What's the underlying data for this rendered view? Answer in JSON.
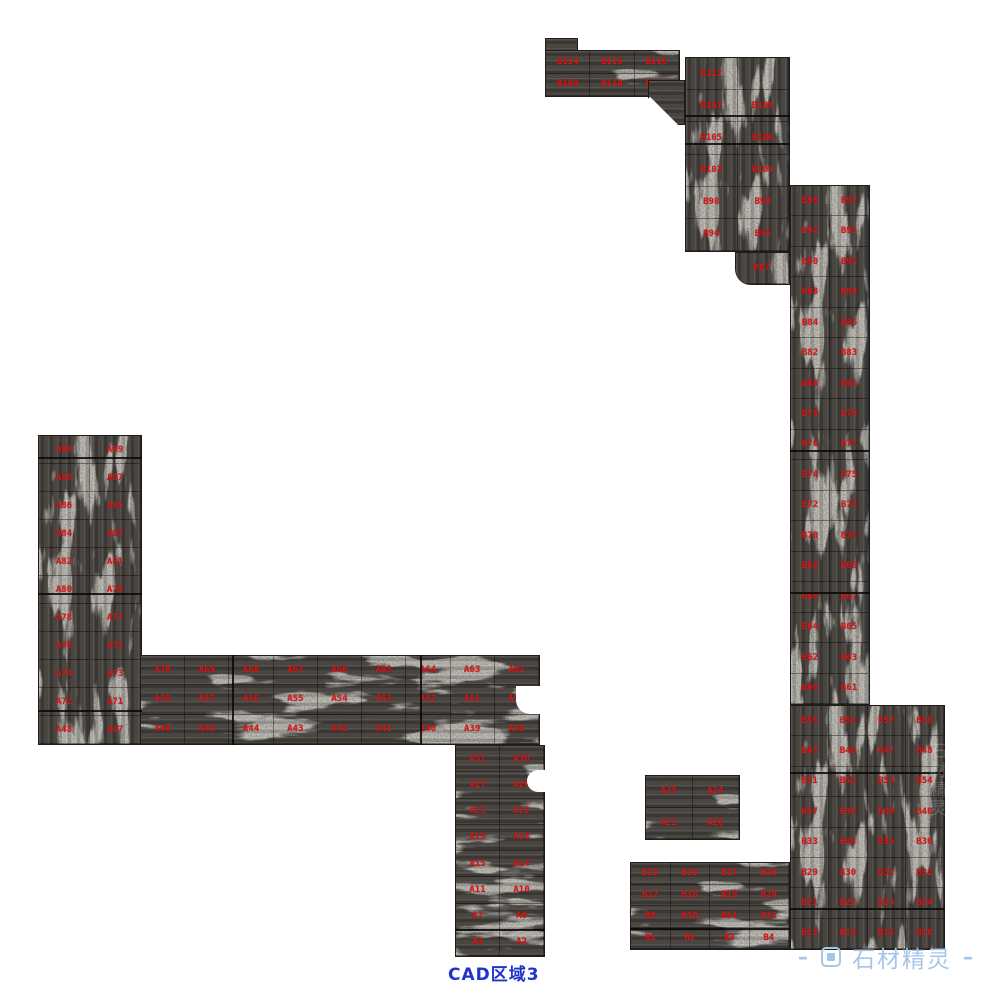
{
  "canvas": {
    "w": 982,
    "h": 1000
  },
  "caption": {
    "text": "CAD区域3"
  },
  "watermark": {
    "left_dash": "–",
    "right_dash": "–",
    "brand": "石材精灵"
  },
  "colors": {
    "label_red": "#e01212",
    "caption_blue": "#2233cc",
    "watermark_blue": "#a5c6e9",
    "stone_base": "#46423e",
    "stone_vein": "#d6d2c8"
  },
  "stamps": [
    {
      "x": 924,
      "y": 742,
      "text": "石材精灵",
      "opacity": 0.22
    },
    {
      "x": 940,
      "y": 88,
      "text": "石材精灵",
      "opacity": 0.13
    }
  ],
  "clusters": [
    {
      "id": "top-step",
      "x": 545,
      "y": 38,
      "w": 33,
      "h": 14,
      "dir": "h",
      "cols": 0,
      "rows": 0,
      "labels": []
    },
    {
      "id": "top-strip",
      "x": 545,
      "y": 50,
      "w": 135,
      "h": 47,
      "dir": "h",
      "cols": 3,
      "rows": 2,
      "labels": [
        [
          "B114",
          "B115",
          "B116"
        ],
        [
          "B109",
          "B110",
          "B111"
        ]
      ]
    },
    {
      "id": "strip-join",
      "x": 648,
      "y": 80,
      "w": 37,
      "h": 45,
      "dir": "h",
      "cols": 0,
      "rows": 0,
      "labels": []
    },
    {
      "id": "upper-right-column",
      "x": 685,
      "y": 57,
      "w": 105,
      "h": 195,
      "dir": "v",
      "cols": 2,
      "rows": 6,
      "labels": [
        [
          "B112",
          ""
        ],
        [
          "B107",
          "B108"
        ],
        [
          "B105",
          "B106"
        ],
        [
          "B103",
          "B104"
        ],
        [
          "B98",
          "B99"
        ],
        [
          "B94",
          "B95"
        ]
      ]
    },
    {
      "id": "column-foot",
      "x": 735,
      "y": 252,
      "w": 55,
      "h": 33,
      "dir": "v",
      "cols": 1,
      "rows": 1,
      "radius": "0 0 0 16px",
      "labels": [
        [
          "B87"
        ]
      ]
    },
    {
      "id": "right-main-column",
      "x": 790,
      "y": 185,
      "w": 80,
      "h": 520,
      "dir": "v",
      "cols": 2,
      "rows": 17,
      "labels": [
        [
          "B96",
          "B97"
        ],
        [
          "B92",
          "B93"
        ],
        [
          "B90",
          "B91"
        ],
        [
          "B88",
          "B89"
        ],
        [
          "B84",
          "B85"
        ],
        [
          "B82",
          "B83"
        ],
        [
          "B80",
          "B81"
        ],
        [
          "B78",
          "B79"
        ],
        [
          "B76",
          "B77"
        ],
        [
          "B74",
          "B75"
        ],
        [
          "B72",
          "B73"
        ],
        [
          "B70",
          "B71"
        ],
        [
          "B68",
          "B69"
        ],
        [
          "B66",
          "B67"
        ],
        [
          "B64",
          "B65"
        ],
        [
          "B62",
          "B63"
        ],
        [
          "B60",
          "B61"
        ]
      ]
    },
    {
      "id": "right-bottom-block",
      "x": 790,
      "y": 705,
      "w": 155,
      "h": 245,
      "dir": "v",
      "cols": 4,
      "rows": 8,
      "labels": [
        [
          "B55",
          "B56",
          "B57",
          "B58"
        ],
        [
          "B45",
          "B46",
          "B47",
          "B48"
        ],
        [
          "B51",
          "B52",
          "B53",
          "B54"
        ],
        [
          "B37",
          "B38",
          "B39",
          "B40"
        ],
        [
          "B33",
          "B34",
          "B35",
          "B36"
        ],
        [
          "B29",
          "B30",
          "B31",
          "B32"
        ],
        [
          "B21",
          "B22",
          "B23",
          "B24"
        ],
        [
          "B13",
          "B14",
          "B15",
          "B16"
        ]
      ]
    },
    {
      "id": "left-column",
      "x": 38,
      "y": 435,
      "w": 104,
      "h": 310,
      "dir": "v",
      "cols": 2,
      "rows": 11,
      "labels": [
        [
          "A90",
          "A89"
        ],
        [
          "A88",
          "A87"
        ],
        [
          "A86",
          "A85"
        ],
        [
          "A84",
          "A83"
        ],
        [
          "A82",
          "A81"
        ],
        [
          "A80",
          "A79"
        ],
        [
          "A78",
          "A77"
        ],
        [
          "A76",
          "A75"
        ],
        [
          "A74",
          "A73"
        ],
        [
          "A72",
          "A71"
        ],
        [
          "A48",
          "A47"
        ]
      ]
    },
    {
      "id": "middle-strip",
      "x": 140,
      "y": 655,
      "w": 400,
      "h": 90,
      "dir": "h",
      "cols": 9,
      "rows": 3,
      "labels": [
        [
          "A70",
          "A69",
          "A68",
          "A67",
          "A66",
          "A65",
          "A64",
          "A63",
          "A62"
        ],
        [
          "A58",
          "A57",
          "A56",
          "A55",
          "A54",
          "A53",
          "A52",
          "A51",
          "A50"
        ],
        [
          "A46",
          "A45",
          "A44",
          "A43",
          "A42",
          "A41",
          "A40",
          "A39",
          "A38"
        ]
      ]
    },
    {
      "id": "bottom-middle-column",
      "x": 455,
      "y": 745,
      "w": 90,
      "h": 212,
      "dir": "h",
      "cols": 2,
      "rows": 8,
      "labels": [
        [
          "A31",
          "A30"
        ],
        [
          "A27",
          "A26"
        ],
        [
          "A23",
          "A22"
        ],
        [
          "A19",
          "A18"
        ],
        [
          "A15",
          "A14"
        ],
        [
          "A11",
          "A10"
        ],
        [
          "A7",
          "A6"
        ],
        [
          "A3",
          "A2"
        ]
      ]
    },
    {
      "id": "small-middle-cluster",
      "x": 645,
      "y": 775,
      "w": 95,
      "h": 65,
      "dir": "h",
      "cols": 2,
      "rows": 2,
      "labels": [
        [
          "A25",
          "A24"
        ],
        [
          "A21",
          "A20"
        ]
      ]
    },
    {
      "id": "bottom-cluster",
      "x": 630,
      "y": 862,
      "w": 160,
      "h": 88,
      "dir": "h",
      "cols": 4,
      "rows": 4,
      "labels": [
        [
          "B25",
          "B26",
          "B27",
          "B28"
        ],
        [
          "B17",
          "B18",
          "B19",
          "B20"
        ],
        [
          "B9",
          "B10",
          "B11",
          "B12"
        ],
        [
          "B1",
          "B2",
          "B3",
          "B4"
        ]
      ]
    }
  ],
  "cutouts": [
    {
      "x": 630,
      "y": 105,
      "w": 40,
      "h": 40,
      "rot": 45,
      "r": "0"
    },
    {
      "x": 516,
      "y": 686,
      "w": 30,
      "h": 28,
      "rot": 0,
      "r": "0 0 0 14px"
    },
    {
      "x": 527,
      "y": 770,
      "w": 18,
      "h": 22,
      "rot": 0,
      "r": "12px 0 0 12px"
    }
  ],
  "dividers": [
    {
      "o": "h",
      "x": 685,
      "y": 115,
      "len": 105
    },
    {
      "o": "h",
      "x": 685,
      "y": 143,
      "len": 105
    },
    {
      "o": "h",
      "x": 38,
      "y": 457,
      "len": 104
    },
    {
      "o": "h",
      "x": 38,
      "y": 593,
      "len": 104
    },
    {
      "o": "h",
      "x": 38,
      "y": 710,
      "len": 104
    },
    {
      "o": "h",
      "x": 790,
      "y": 450,
      "len": 80
    },
    {
      "o": "h",
      "x": 790,
      "y": 592,
      "len": 80
    },
    {
      "o": "h",
      "x": 790,
      "y": 772,
      "len": 155
    },
    {
      "o": "h",
      "x": 790,
      "y": 908,
      "len": 155
    },
    {
      "o": "h",
      "x": 455,
      "y": 929,
      "len": 90
    },
    {
      "o": "h",
      "x": 630,
      "y": 928,
      "len": 160
    },
    {
      "o": "v",
      "x": 232,
      "y": 655,
      "len": 90
    },
    {
      "o": "v",
      "x": 420,
      "y": 655,
      "len": 90
    }
  ]
}
